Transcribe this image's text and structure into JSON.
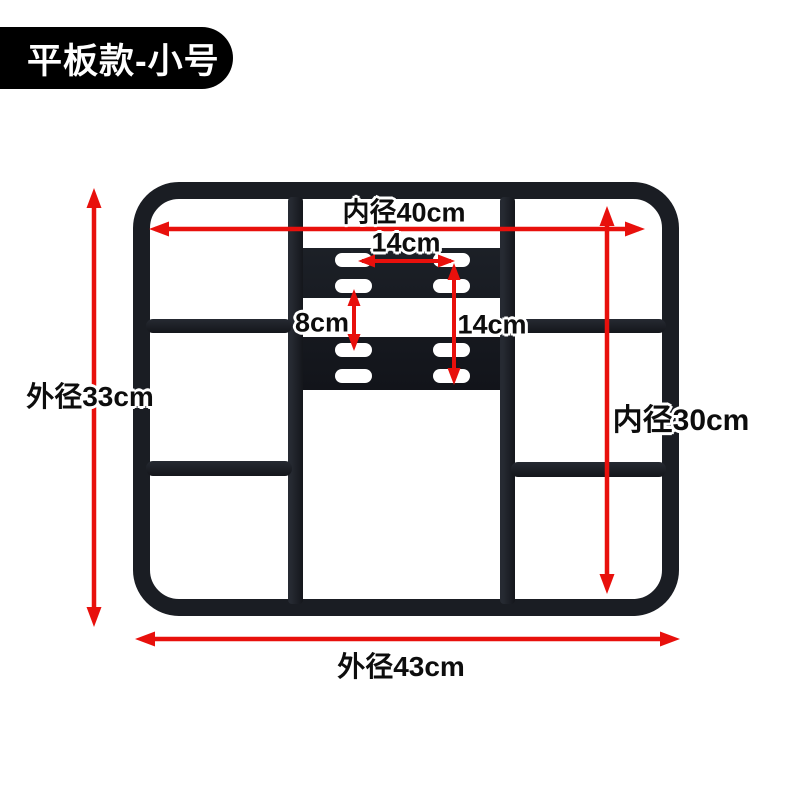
{
  "badge": {
    "text": "平板款-小号"
  },
  "colors": {
    "arrow_red": "#e8100c",
    "tube_black": "#1a1d23",
    "badge_bg": "#000000",
    "badge_text": "#ffffff"
  },
  "dimensions": {
    "inner_width": "内径40cm",
    "slot_width": "14cm",
    "slot_gap": "8cm",
    "slot_height": "14cm",
    "outer_height": "外径33cm",
    "inner_height": "内径30cm",
    "outer_width": "外径43cm"
  }
}
